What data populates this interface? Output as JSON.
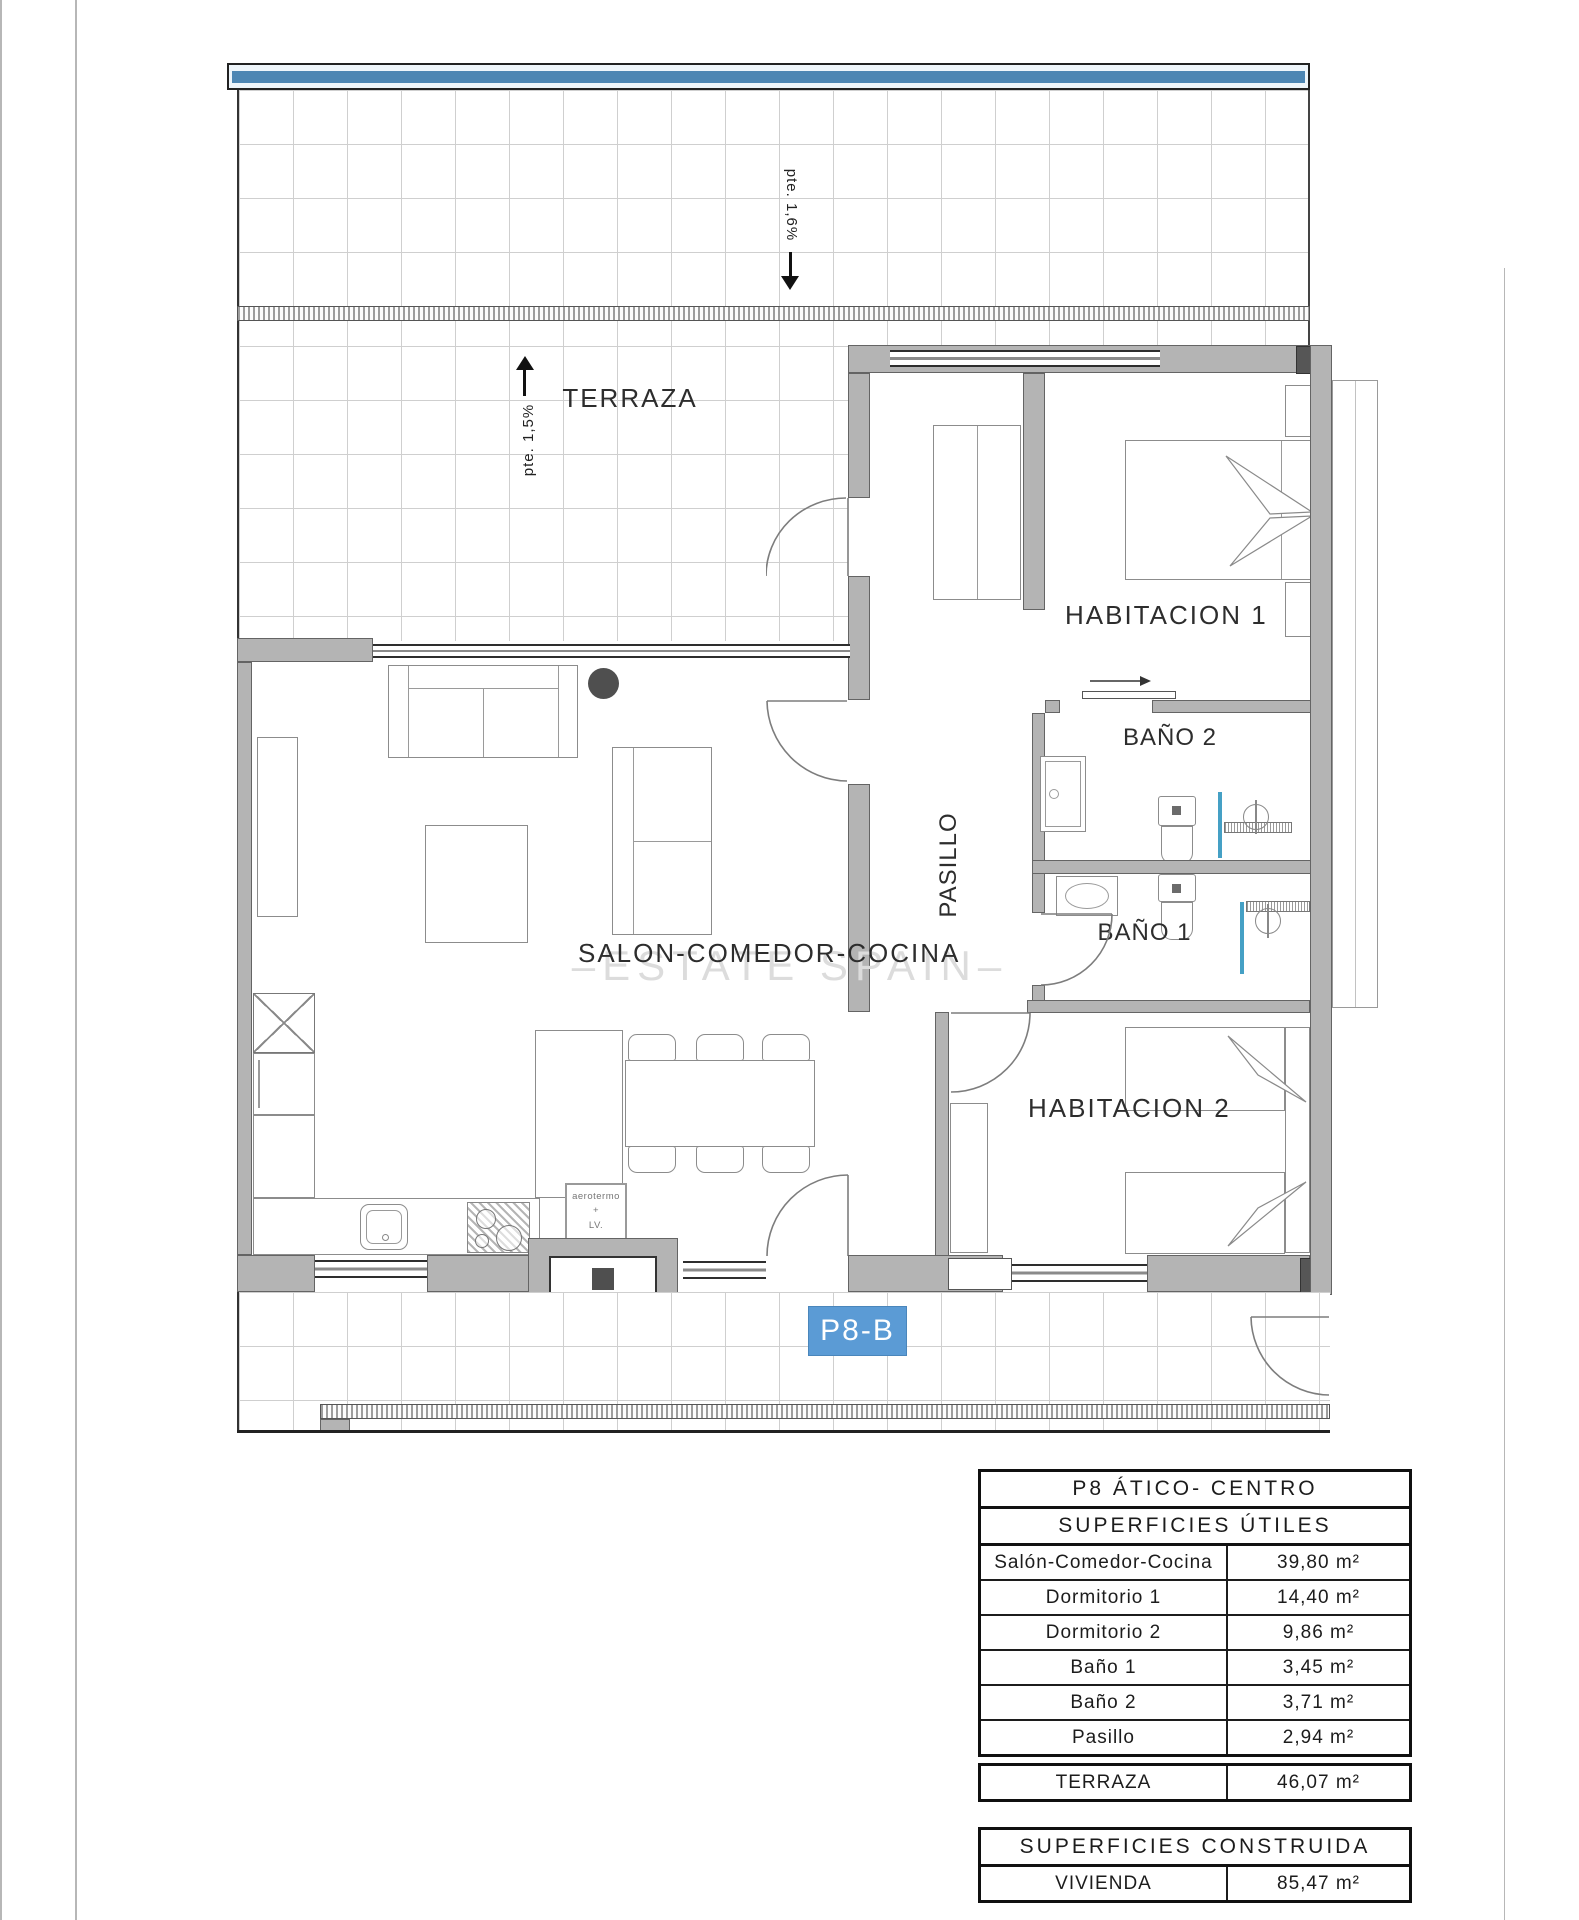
{
  "plan": {
    "badge": "P8-B",
    "watermark": "–ESTATE SPAIN–",
    "labels": {
      "terraza": "TERRAZA",
      "habitacion1": "HABITACION 1",
      "habitacion2": "HABITACION 2",
      "bano1": "BAÑO 1",
      "bano2": "BAÑO 2",
      "salon": "SALON-COMEDOR-COCINA",
      "pasillo": "PASILLO"
    },
    "annotations": {
      "slope_top": "pte. 1,6%",
      "slope_left": "pte. 1,5%",
      "aerotermo_line1": "aerotermo",
      "aerotermo_line2": "+",
      "aerotermo_line3": "LV."
    },
    "colors": {
      "badge_bg": "#5b9bd5",
      "parapet_blue": "#4d86b3",
      "fixture_blue": "#45a0c5",
      "wall_gray": "#b4b4b4"
    }
  },
  "tables": {
    "utiles": {
      "title": "P8 ÁTICO- CENTRO",
      "subtitle": "SUPERFICIES ÚTILES",
      "rows": [
        {
          "label": "Salón-Comedor-Cocina",
          "value": "39,80 m²"
        },
        {
          "label": "Dormitorio 1",
          "value": "14,40 m²"
        },
        {
          "label": "Dormitorio 2",
          "value": "9,86 m²"
        },
        {
          "label": "Baño 1",
          "value": "3,45 m²"
        },
        {
          "label": "Baño 2",
          "value": "3,71 m²"
        },
        {
          "label": "Pasillo",
          "value": "2,94 m²"
        }
      ]
    },
    "terraza": {
      "rows": [
        {
          "label": "TERRAZA",
          "value": "46,07 m²"
        }
      ]
    },
    "construida": {
      "title": "SUPERFICIES CONSTRUIDA",
      "rows": [
        {
          "label": "VIVIENDA",
          "value": "85,47 m²"
        }
      ]
    }
  }
}
